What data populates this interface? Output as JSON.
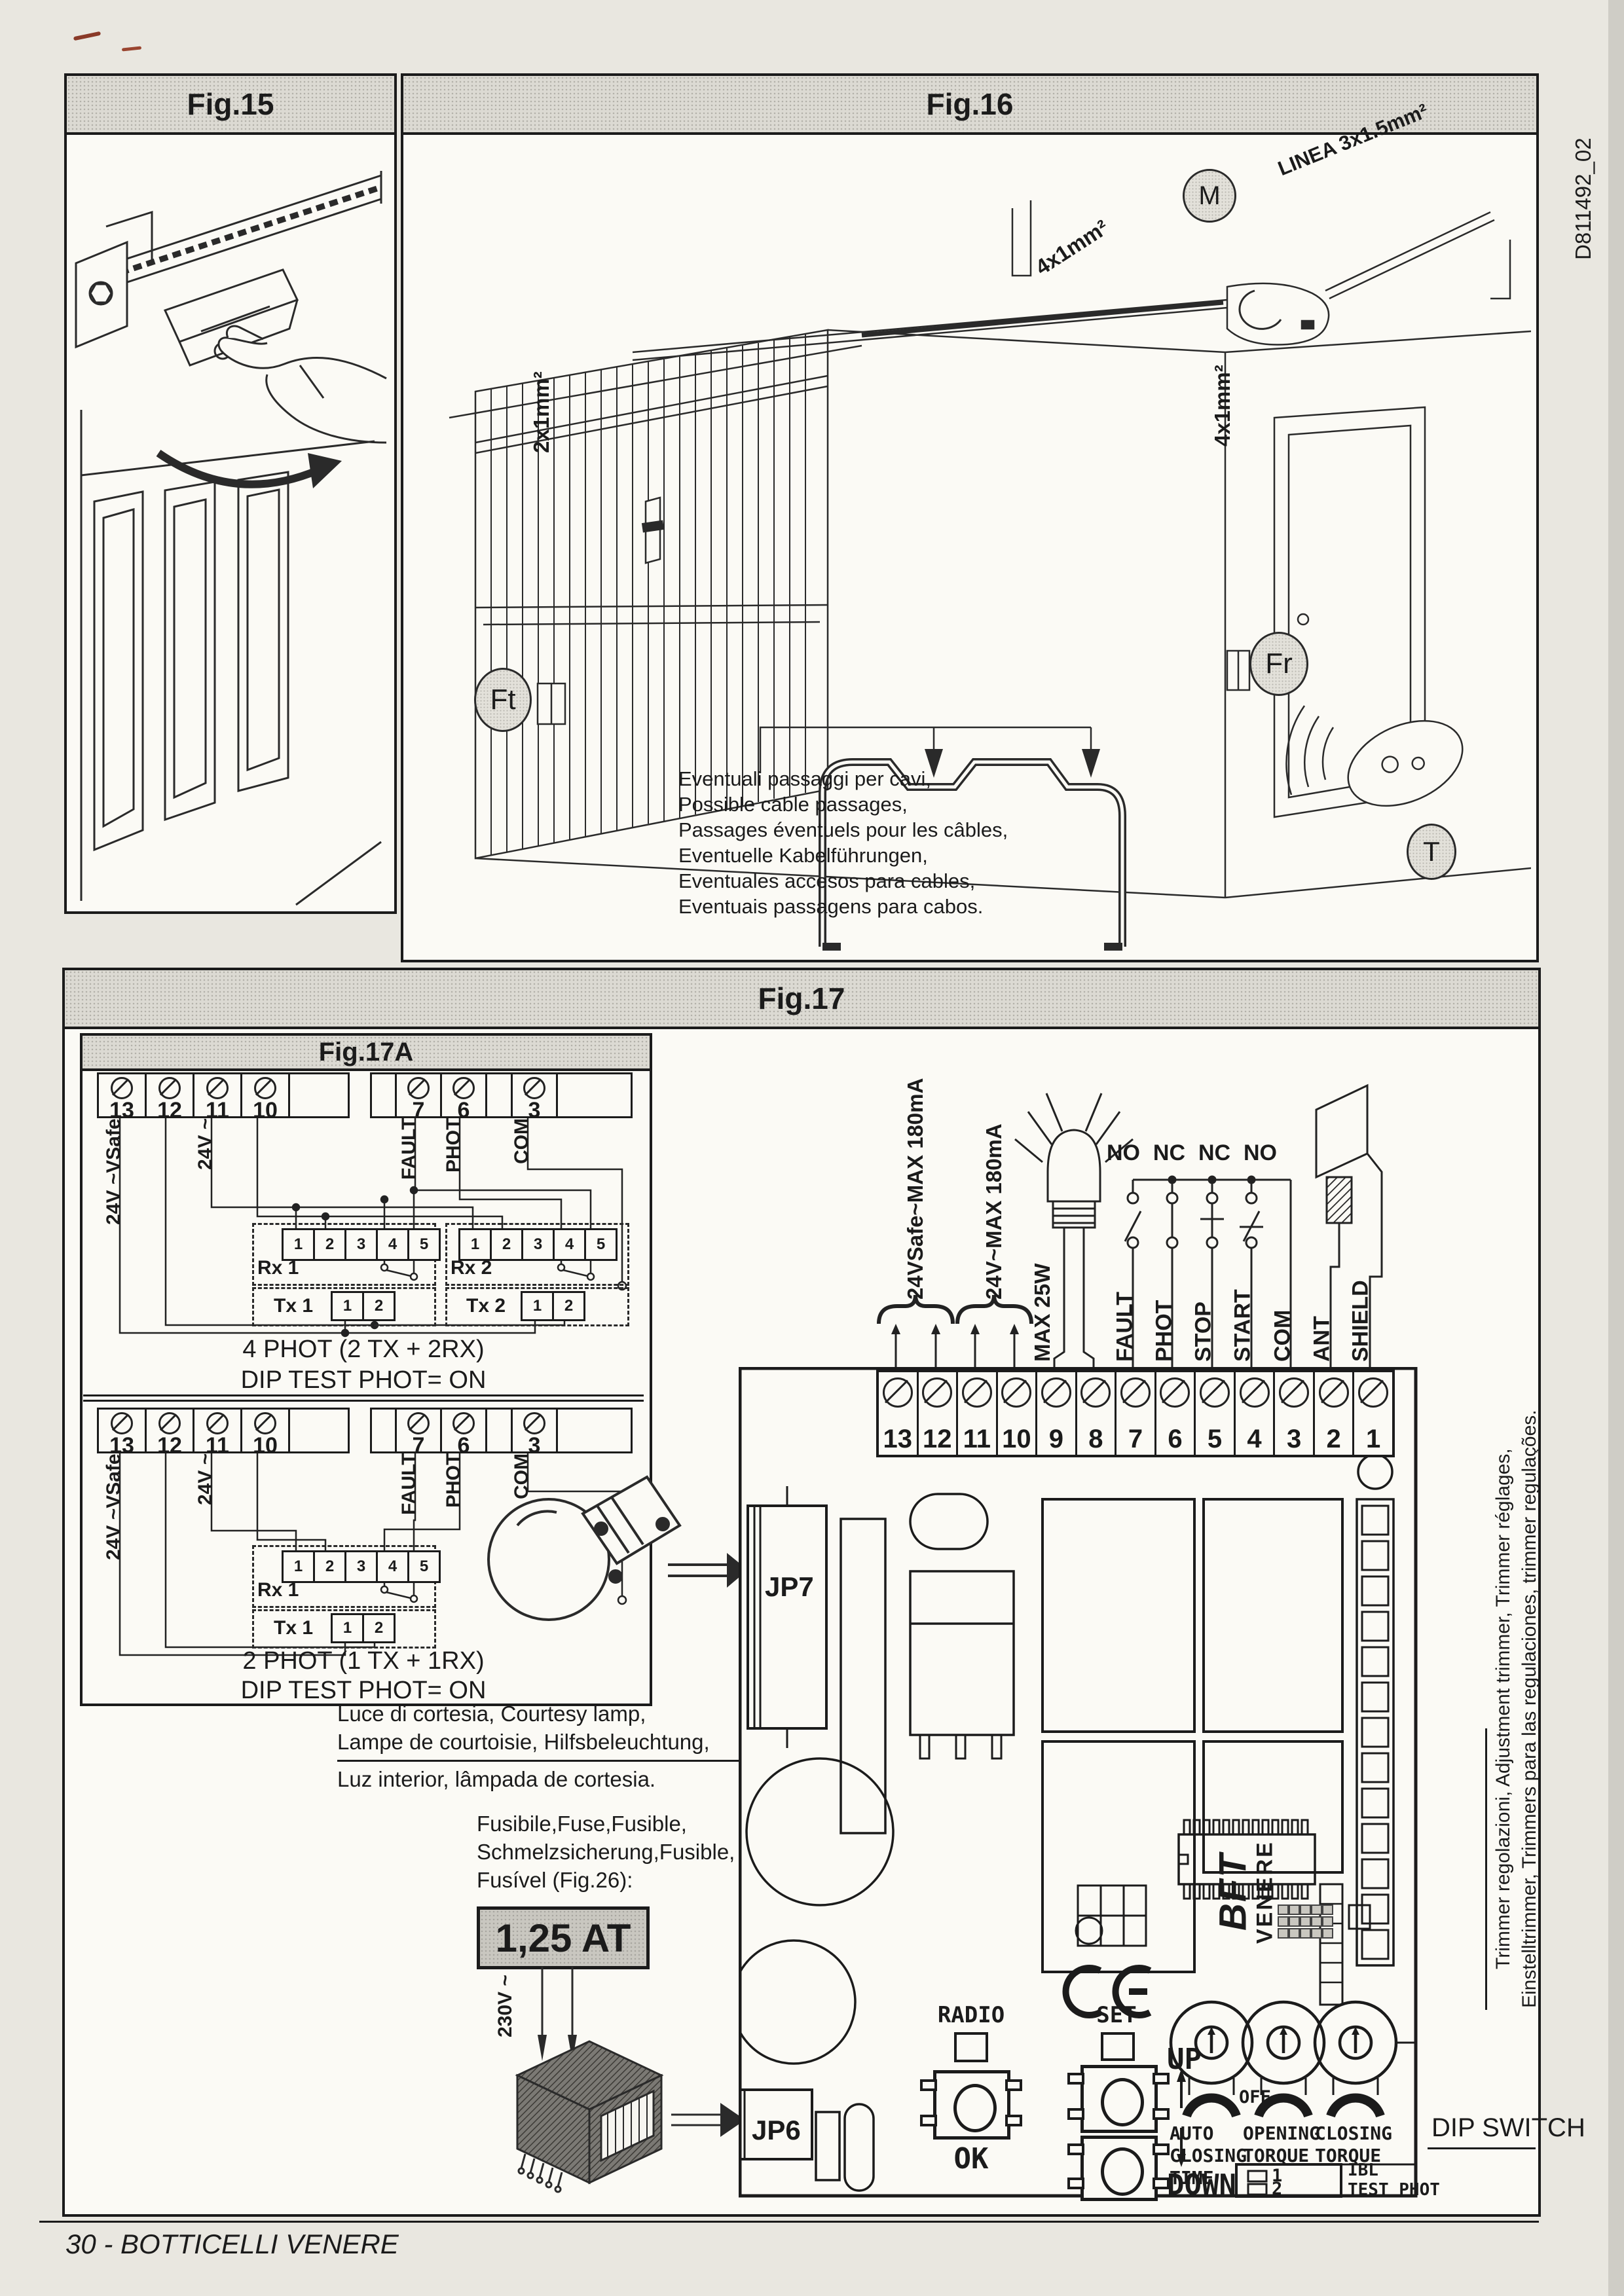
{
  "page": {
    "footer": "30 - BOTTICELLI VENERE",
    "doc_code": "D811492_02"
  },
  "fig15": {
    "title": "Fig.15"
  },
  "fig16": {
    "title": "Fig.16",
    "motor": "M",
    "linea": "LINEA 3x1.5mm²",
    "cable_rail": "4x1mm²",
    "cable_left": "2x1mm²",
    "cable_right": "4x1mm²",
    "ft": "Ft",
    "fr": "Fr",
    "t": "T",
    "passages": [
      "Eventuali passaggi per cavi,",
      "Possible cable passages,",
      "Passages éventuels pour les câbles,",
      "Eventuelle Kabelführungen,",
      "Eventuales accesos para cables,",
      "Eventuais passagens para cabos."
    ]
  },
  "fig17": {
    "title": "Fig.17",
    "fig17a": {
      "title": "Fig.17A",
      "left_terminals": [
        "13",
        "12",
        "11",
        "10"
      ],
      "right_terminals": [
        "7",
        "6",
        "3"
      ],
      "v24safe": "24V ~VSafe",
      "v24": "24V ~",
      "fault": "FAULT",
      "phot": "PHOT",
      "com": "COM",
      "rx_pins": [
        "1",
        "2",
        "3",
        "4",
        "5"
      ],
      "tx_pins": [
        "1",
        "2"
      ],
      "rx1": "Rx 1",
      "rx2": "Rx 2",
      "tx1": "Tx 1",
      "tx2": "Tx 2",
      "caption4_line1": "4 PHOT  (2 TX + 2RX)",
      "caption4_line2": "DIP TEST PHOT= ON",
      "caption2_line1": "2 PHOT  (1 TX + 1RX)",
      "caption2_line2": "DIP TEST PHOT= ON"
    },
    "courtesy": [
      "Luce di cortesia, Courtesy lamp,",
      "Lampe de courtoisie, Hilfsbeleuchtung,",
      "Luz interior, lâmpada de cortesia."
    ],
    "fuse": [
      "Fusibile,Fuse,Fusible,",
      "Schmelzsicherung,Fusible,",
      "Fusível (Fig.26):"
    ],
    "fuse_rating": "1,25 AT",
    "mains": "230V ~",
    "board": {
      "terminals": [
        "13",
        "12",
        "11",
        "10",
        "9",
        "8",
        "7",
        "6",
        "5",
        "4",
        "3",
        "2",
        "1"
      ],
      "supply_safe": "24VSafe~MAX 180mA",
      "supply_24": "24V~MAX 180mA",
      "lamp_max": "MAX 25W",
      "contacts": [
        "NO",
        "NC",
        "NC",
        "NO"
      ],
      "signals": [
        "FAULT",
        "PHOT",
        "STOP",
        "START",
        "COM",
        "ANT",
        "SHIELD"
      ],
      "jp7": "JP7",
      "jp6": "JP6",
      "brand": "BFT",
      "brand2": "VENERE",
      "radio": "RADIO",
      "set": "SET",
      "ok": "OK",
      "up": "UP",
      "down": "DOWN",
      "off": "OFF",
      "trim1": [
        "AUTO",
        "CLOSING",
        "TIME"
      ],
      "trim2": [
        "OPENING",
        "TORQUE"
      ],
      "trim3": [
        "CLOSING",
        "TORQUE"
      ],
      "dip_numbers": [
        "1",
        "2"
      ],
      "dip_ibl": "IBL",
      "dip_test": "TEST PHOT",
      "dip_switch": "DIP SWITCH"
    },
    "side_note": [
      "Trimmer regolazioni, Adjustment trimmer, Trimmer réglages,",
      "Einstelltrimmer, Trimmers para las regulaciones, trimmer regulações."
    ]
  }
}
